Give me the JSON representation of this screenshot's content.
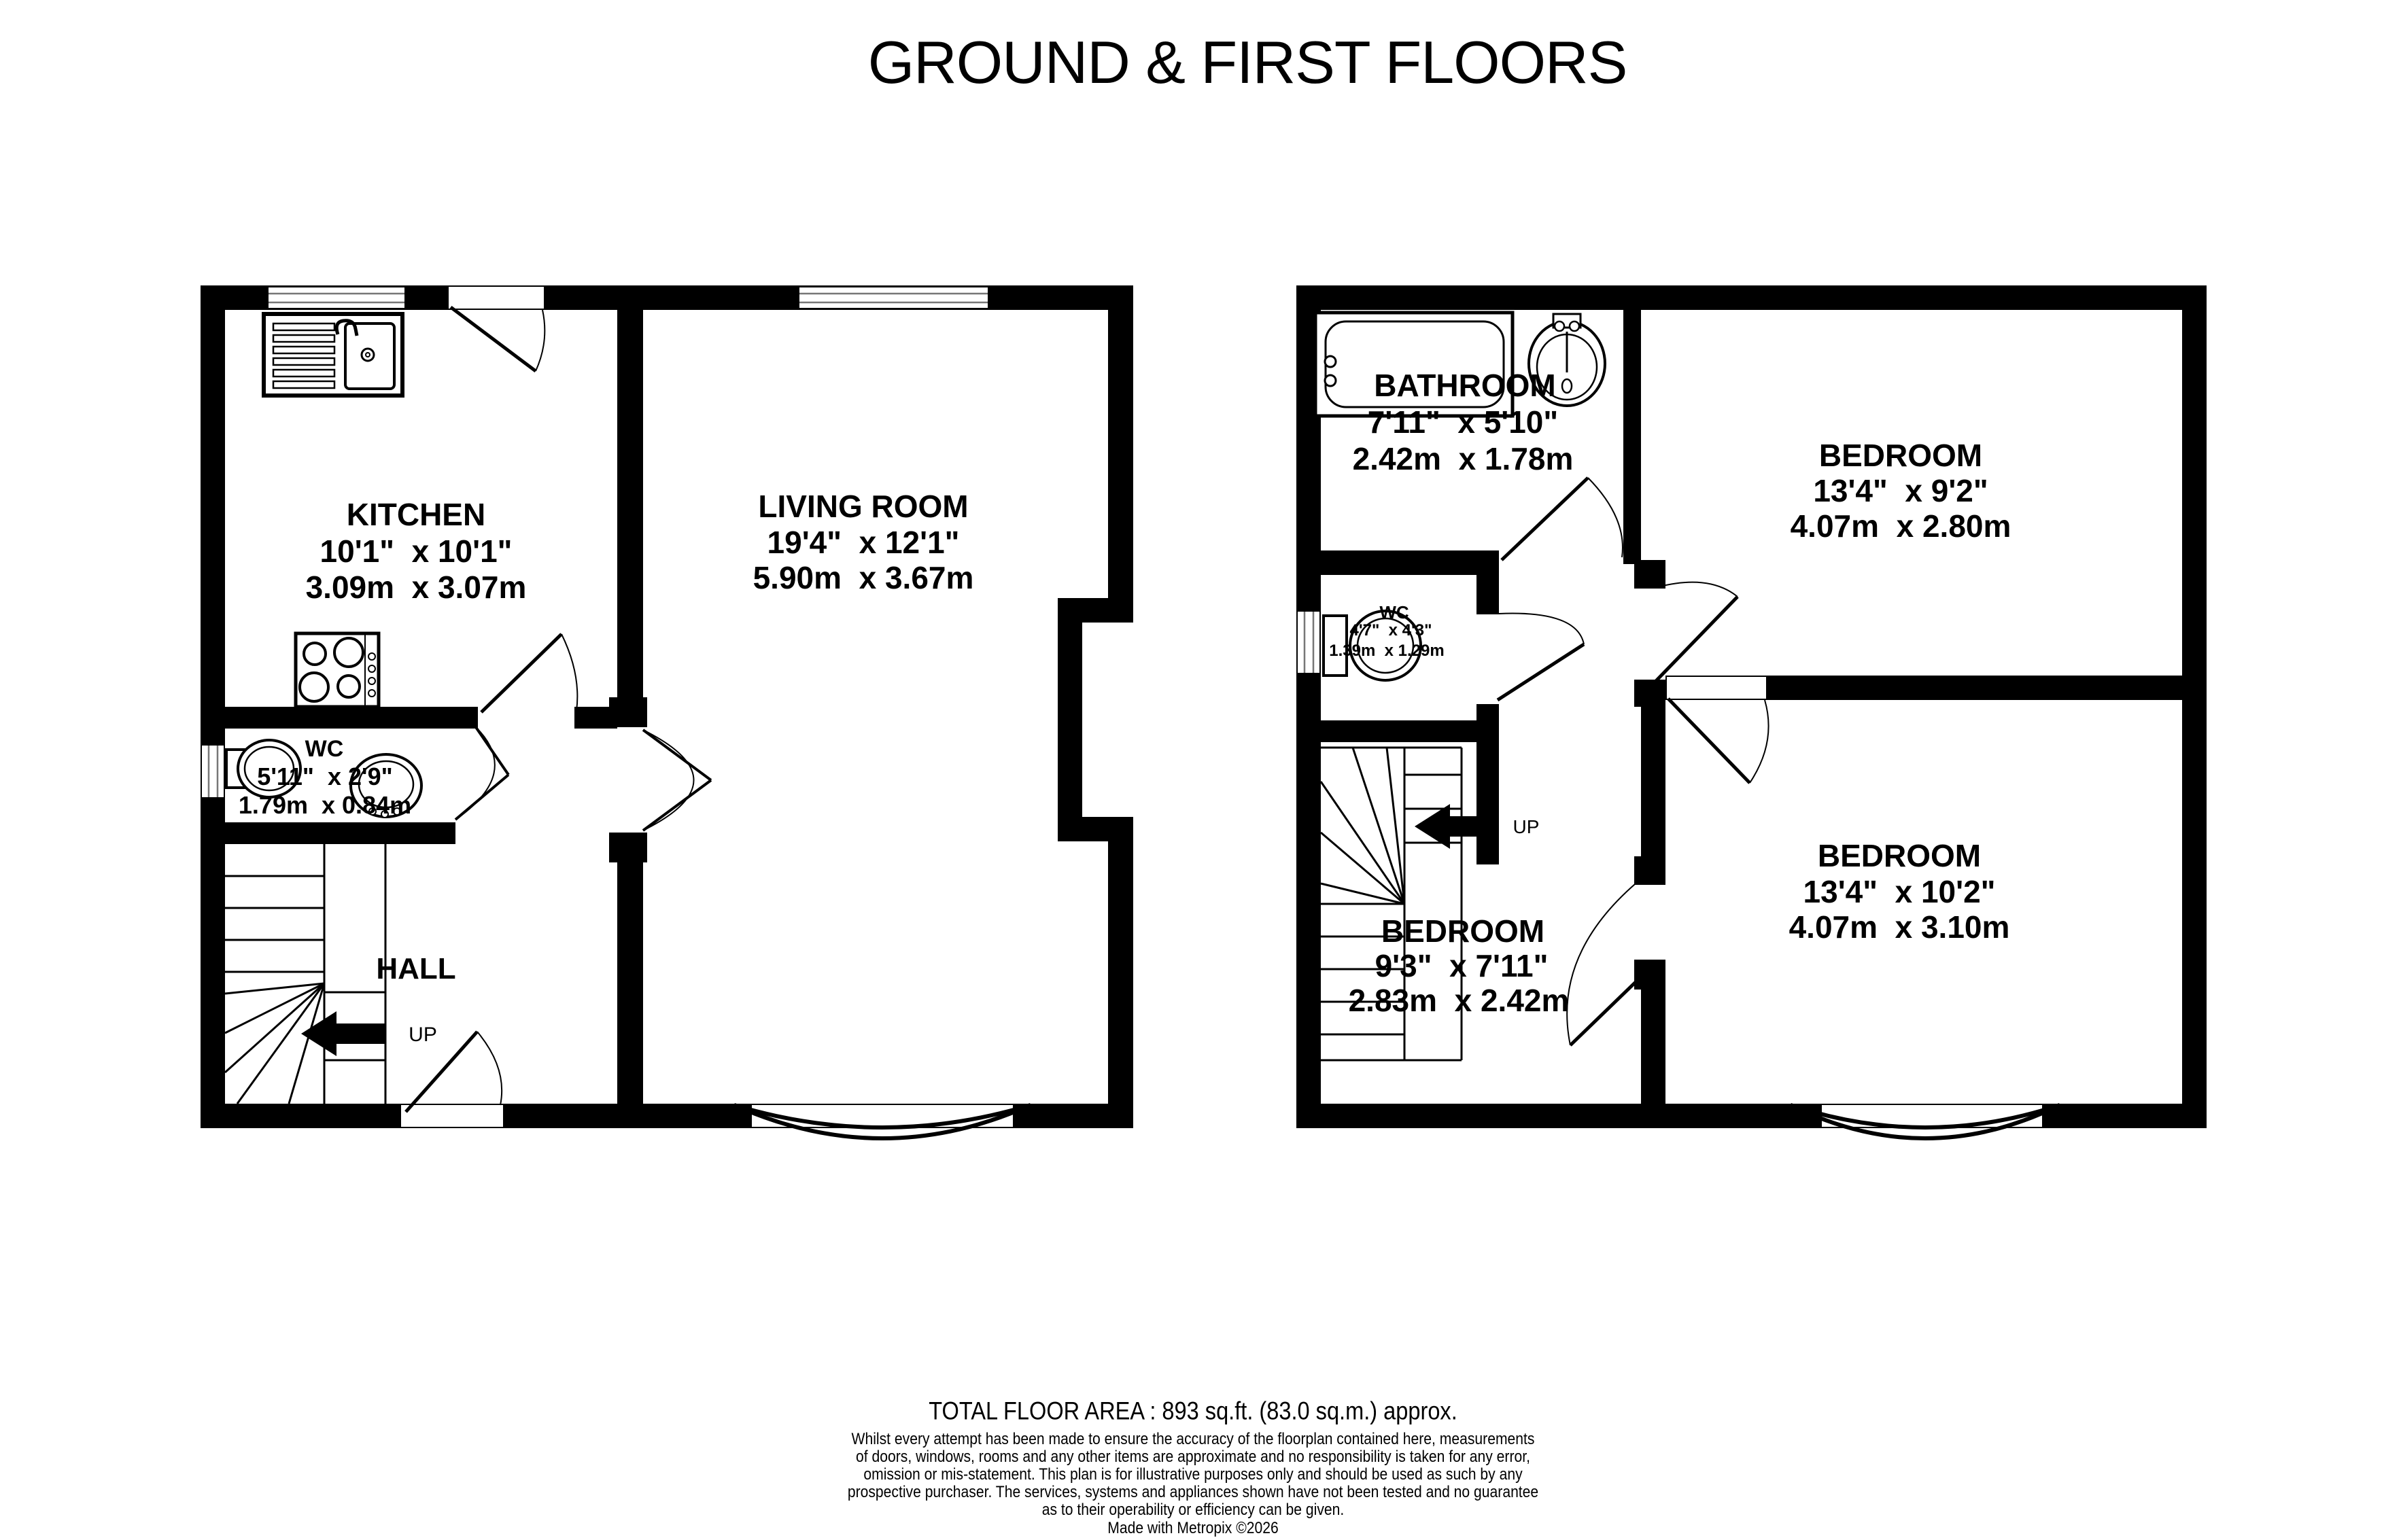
{
  "title": "GROUND & FIRST FLOORS",
  "rooms": {
    "kitchen": {
      "name": "KITCHEN",
      "imperial": "10'1\"  x 10'1\"",
      "metric": "3.09m  x 3.07m"
    },
    "living": {
      "name": "LIVING ROOM",
      "imperial": "19'4\"  x 12'1\"",
      "metric": "5.90m  x 3.67m"
    },
    "wc_ground": {
      "name": "WC",
      "imperial": "5'11\"  x 2'9\"",
      "metric": "1.79m  x 0.84m"
    },
    "hall": {
      "name": "HALL"
    },
    "bathroom": {
      "name": "BATHROOM",
      "imperial": "7'11\"  x 5'10\"",
      "metric": "2.42m  x 1.78m"
    },
    "wc_first": {
      "name": "WC",
      "imperial": "4'7\"  x 4'3\"",
      "metric": "1.39m  x 1.29m"
    },
    "bedroom_1": {
      "name": "BEDROOM",
      "imperial": "13'4\"  x 9'2\"",
      "metric": "4.07m  x 2.80m"
    },
    "bedroom_2": {
      "name": "BEDROOM",
      "imperial": "13'4\"  x 10'2\"",
      "metric": "4.07m  x 3.10m"
    },
    "bedroom_3": {
      "name": "BEDROOM",
      "imperial": "9'3\"  x 7'11\"",
      "metric": "2.83m  x 2.42m"
    }
  },
  "stairs": {
    "ground_up": "UP",
    "first_up": "UP"
  },
  "icons": {
    "ground_floor": [
      "kitchen-sink",
      "stove",
      "toilet",
      "wash-basin",
      "stairs-up-arrow"
    ],
    "first_floor": [
      "bathtub",
      "pedestal-sink",
      "toilet",
      "stairs-up-arrow"
    ]
  },
  "footer": {
    "total_area": "TOTAL FLOOR AREA : 893 sq.ft. (83.0 sq.m.) approx.",
    "disclaimer_lines": [
      "Whilst every attempt has been made to ensure the accuracy of the floorplan contained here, measurements",
      "of doors, windows, rooms and any other items are approximate and no responsibility is taken for any error,",
      "omission or mis-statement. This plan is for illustrative purposes only and should be used as such by any",
      "prospective purchaser. The services, systems and appliances shown have not been tested and no guarantee",
      "as to their operability or efficiency can be given."
    ],
    "credit": "Made with Metropix ©2026"
  },
  "colors": {
    "wall": "#000000",
    "background": "#ffffff",
    "window_frame": "#777777"
  }
}
